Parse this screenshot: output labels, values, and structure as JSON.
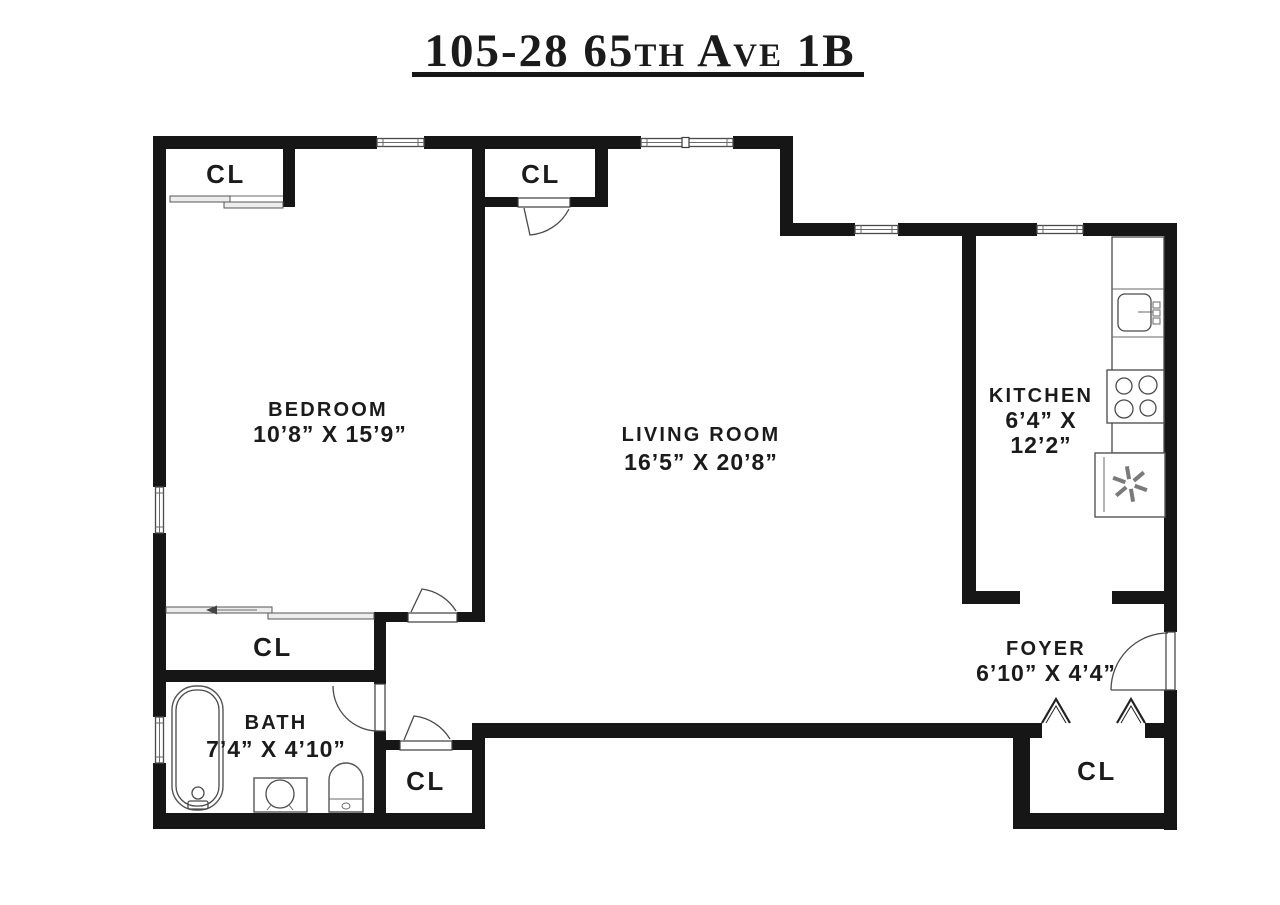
{
  "title": {
    "text": "105-28 65th Ave 1B"
  },
  "rooms": {
    "bedroom": {
      "name": "BEDROOM",
      "dims": "10’8” X 15’9”"
    },
    "living_room": {
      "name": "LIVING ROOM",
      "dims": "16’5” X 20’8”"
    },
    "kitchen": {
      "name": "KITCHEN",
      "dims_line1": "6’4” X",
      "dims_line2": "12’2”"
    },
    "foyer": {
      "name": "FOYER",
      "dims": "6’10” X 4’4”"
    },
    "bath": {
      "name": "BATH",
      "dims": "7’4” X 4’10”"
    }
  },
  "closets": {
    "bedroom_closet": "CL",
    "living_room_closet": "CL",
    "hall_closet": "CL",
    "vestibule_closet": "CL",
    "foyer_closet": "CL"
  },
  "colors": {
    "wall": "#161616",
    "line": "#4a4a4a",
    "background": "#ffffff",
    "text": "#1b1b1b"
  }
}
